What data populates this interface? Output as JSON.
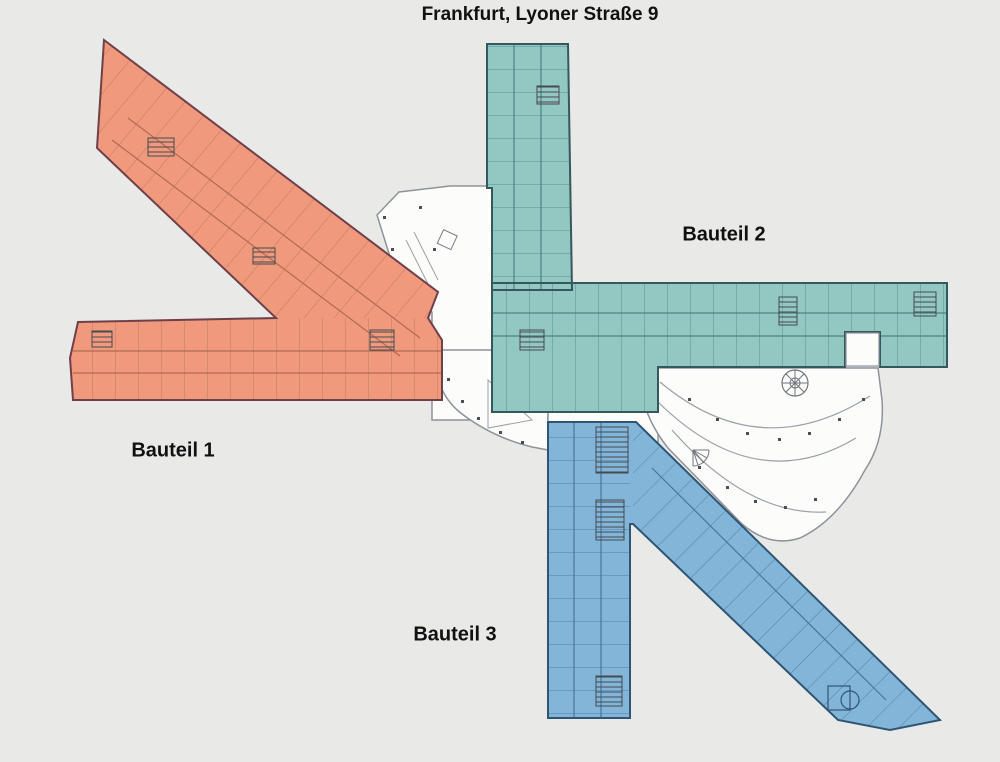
{
  "title": "Frankfurt, Lyoner Straße 9",
  "sections": [
    {
      "id": "bauteil-1",
      "label": "Bauteil 1",
      "fill": "#f0997c",
      "outline": "#6e4049"
    },
    {
      "id": "bauteil-2",
      "label": "Bauteil 2",
      "fill": "#92c7c2",
      "outline": "#35585c"
    },
    {
      "id": "bauteil-3",
      "label": "Bauteil 3",
      "fill": "#82b5d7",
      "outline": "#2e5574"
    }
  ],
  "colors": {
    "background": "#e9e9e7",
    "plan_white": "#fcfcfb",
    "plan_outline": "#8e939b",
    "wall_detail": "#454a50",
    "text": "#111111"
  }
}
